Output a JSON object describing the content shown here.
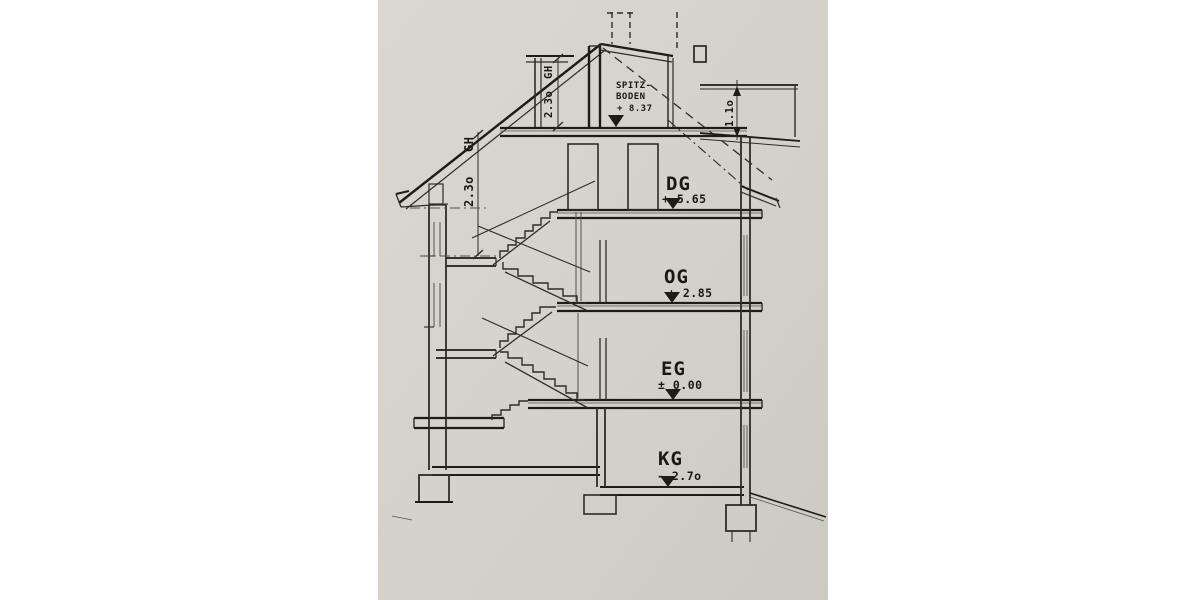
{
  "colors": {
    "background": "#ffffff",
    "paper": "#d5d3ca",
    "ink": "#2b2a25"
  },
  "levels": [
    {
      "id": "spitzboden",
      "label_line1": "SPITZ-",
      "label_line2": "BODEN",
      "elevation": "+ 8.37"
    },
    {
      "id": "dg",
      "label": "DG",
      "elevation": "+ 5.65"
    },
    {
      "id": "og",
      "label": "OG",
      "elevation": "+ 2.85"
    },
    {
      "id": "eg",
      "label": "EG",
      "elevation": "± 0.00"
    },
    {
      "id": "kg",
      "label": "KG",
      "elevation": "- 2.7o"
    }
  ],
  "dimensions": {
    "dormer": {
      "label": "GH",
      "value": "2.3o"
    },
    "roof": {
      "label": "GH",
      "value": "2.3o"
    },
    "railing": {
      "value": "1.1o"
    }
  }
}
